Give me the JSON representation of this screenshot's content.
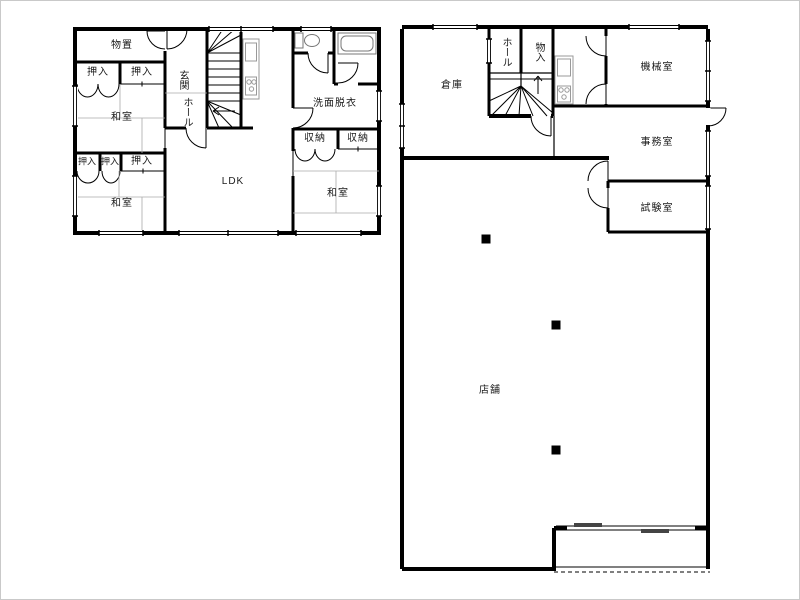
{
  "plans": {
    "residence": {
      "rooms": {
        "storage": "物置",
        "closet_a": "押入",
        "closet_b": "押入",
        "entrance": "玄関",
        "hall": "ホール",
        "washitsu_nw": "和室",
        "closet_c": "押入",
        "closet_d": "押入",
        "closet_e": "押入",
        "washitsu_sw": "和室",
        "ldk": "LDK",
        "washroom": "洗面脱衣",
        "shuno_a": "収納",
        "shuno_b": "収納",
        "washitsu_e": "和室"
      }
    },
    "shop_building": {
      "rooms": {
        "warehouse": "倉庫",
        "hall": "ホール",
        "mono_ire": "物入",
        "machine_room": "機械室",
        "office": "事務室",
        "test_room": "試験室",
        "shop": "店舗"
      }
    }
  },
  "colors": {
    "wall": "#000000",
    "tatami_line": "#aaaaaa",
    "fixture_line": "#999999"
  }
}
